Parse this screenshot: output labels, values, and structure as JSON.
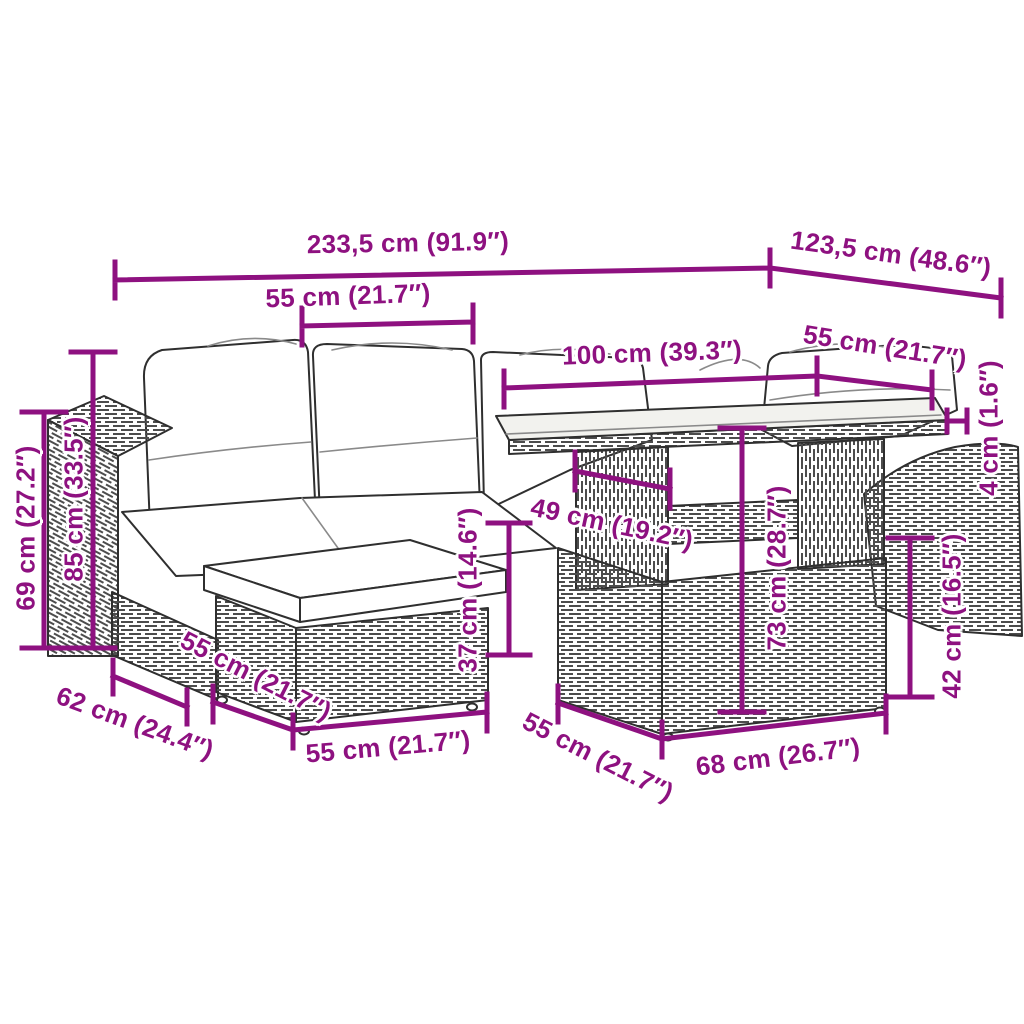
{
  "style": {
    "dimension_color": "#8E1180",
    "outline_color": "#2F2F2F",
    "weave_color": "#4D4D4D",
    "glass_fill": "#F2F2EE",
    "cushion_fill": "#FFFFFF",
    "background": "#FFFFFF"
  },
  "dims": [
    {
      "id": "total-length",
      "label": "233,5 cm (91.9″)"
    },
    {
      "id": "total-depth",
      "label": "123,5 cm (48.6″)"
    },
    {
      "id": "seat-width-top",
      "label": "55 cm (21.7″)"
    },
    {
      "id": "table-length",
      "label": "100 cm (39.3″)"
    },
    {
      "id": "right-seat-width",
      "label": "55 cm (21.7″)"
    },
    {
      "id": "tabletop-thickness",
      "label": "4 cm (1.6″)"
    },
    {
      "id": "back-height",
      "label": "85 cm (33.5″)"
    },
    {
      "id": "arm-height",
      "label": "69 cm (27.2″)"
    },
    {
      "id": "under-table-width",
      "label": "49 cm (19.2″)"
    },
    {
      "id": "cushion-height",
      "label": "37 cm (14.6″)"
    },
    {
      "id": "table-height",
      "label": "73 cm (28.7″)"
    },
    {
      "id": "seat-height",
      "label": "42 cm (16.5″)"
    },
    {
      "id": "arm-depth",
      "label": "62 cm (24.4″)"
    },
    {
      "id": "ottoman-depth",
      "label": "55 cm (21.7″)"
    },
    {
      "id": "ottoman-width",
      "label": "55 cm (21.7″)"
    },
    {
      "id": "bench-depth",
      "label": "55 cm (21.7″)"
    },
    {
      "id": "bench-width",
      "label": "68 cm (26.7″)"
    }
  ]
}
